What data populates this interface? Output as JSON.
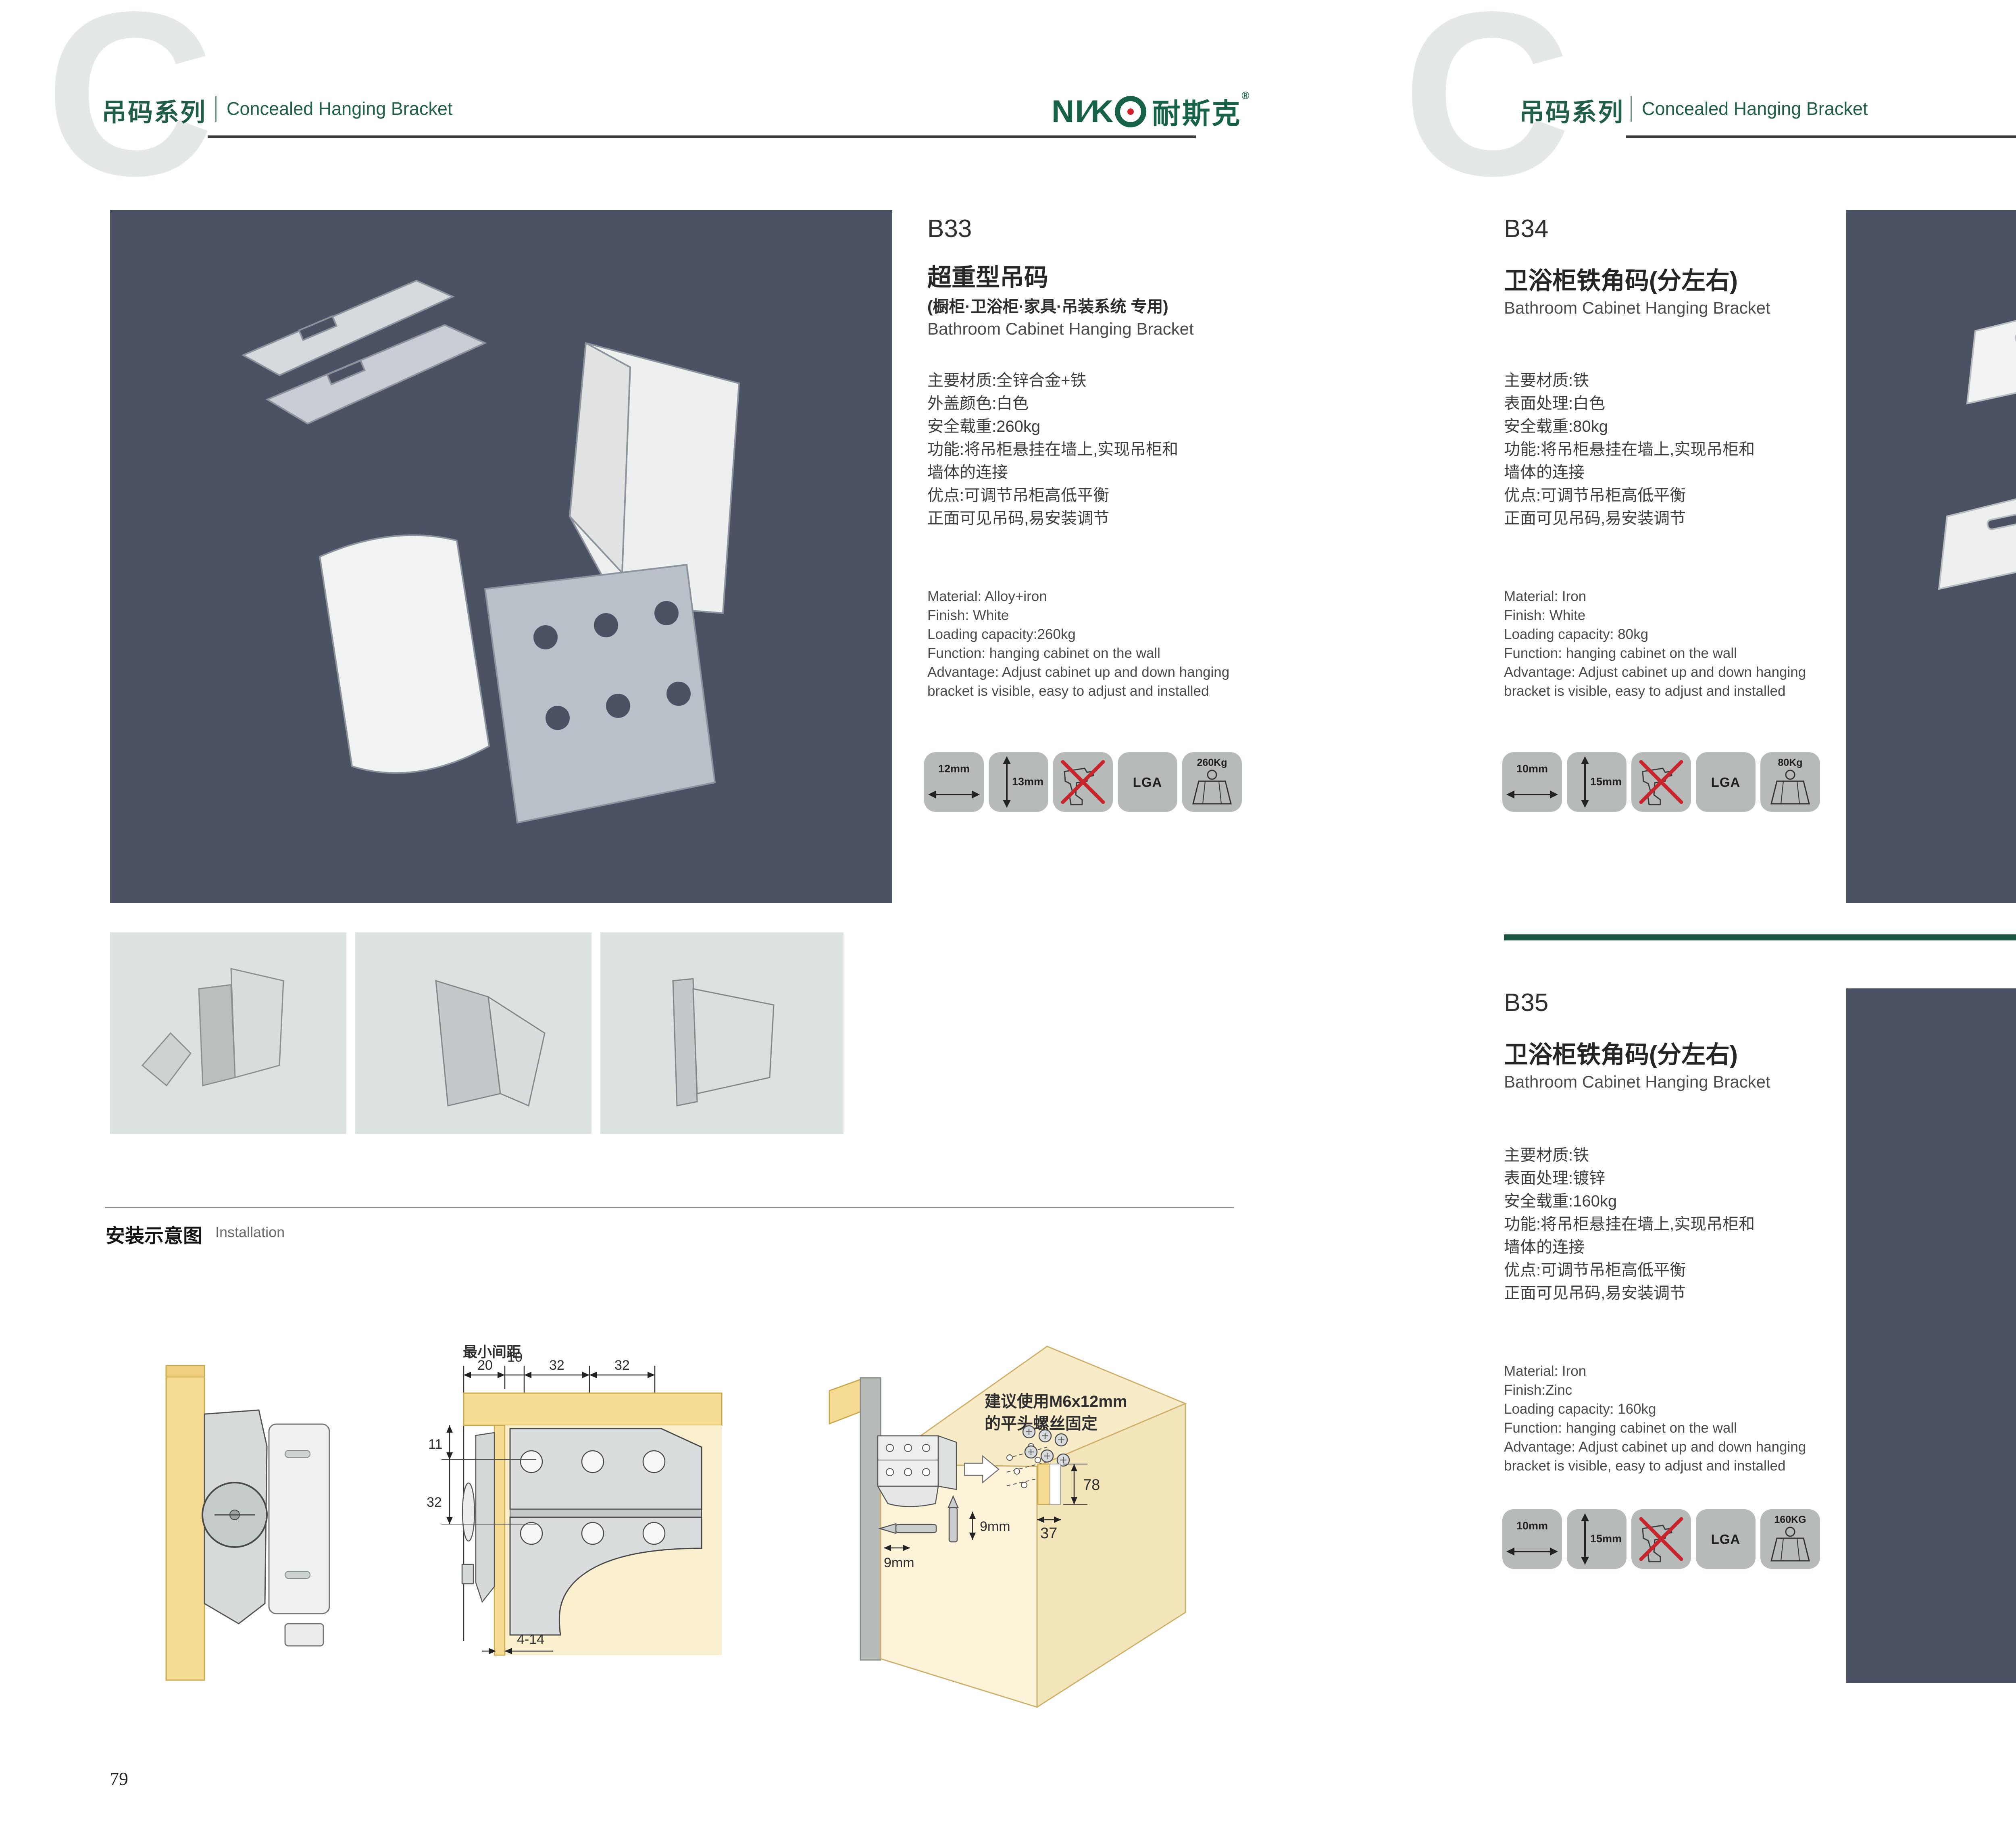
{
  "brand": {
    "watermark": "C",
    "series_zh": "吊码系列",
    "series_en": "Concealed Hanging Bracket",
    "logo_part1": "NI∕K",
    "logo_zh": "耐斯克",
    "logo_reg": "®",
    "green": "#215e49",
    "red": "#c1272d"
  },
  "page_left": {
    "number": "79"
  },
  "page_right": {
    "number": "80"
  },
  "products": {
    "b33": {
      "code": "B33",
      "title_zh": "超重型吊码",
      "subtitle_zh": "(橱柜·卫浴柜·家具·吊装系统 专用)",
      "title_en": "Bathroom Cabinet Hanging Bracket",
      "specs_zh": [
        "主要材质:全锌合金+铁",
        "外盖颜色:白色",
        "安全载重:260kg",
        "功能:将吊柜悬挂在墙上,实现吊柜和",
        "墙体的连接",
        "优点:可调节吊柜高低平衡",
        "正面可见吊码,易安装调节"
      ],
      "specs_en": [
        "Material: Alloy+iron",
        "Finish: White",
        "Loading capacity:260kg",
        "Function: hanging cabinet on the wall",
        "Advantage: Adjust cabinet up and down hanging",
        "bracket is visible, easy to adjust and installed"
      ],
      "icon_width": "12mm",
      "icon_height": "13mm",
      "icon_cert": "LGA",
      "icon_load": "260Kg"
    },
    "b34": {
      "code": "B34",
      "title_zh": "卫浴柜铁角码(分左右)",
      "title_en": "Bathroom Cabinet Hanging Bracket",
      "specs_zh": [
        "主要材质:铁",
        "表面处理:白色",
        "安全载重:80kg",
        "功能:将吊柜悬挂在墙上,实现吊柜和",
        "墙体的连接",
        "优点:可调节吊柜高低平衡",
        "正面可见吊码,易安装调节"
      ],
      "specs_en": [
        "Material: Iron",
        "Finish: White",
        "Loading capacity: 80kg",
        "Function: hanging cabinet on the wall",
        "Advantage: Adjust cabinet up and down hanging",
        "bracket is visible, easy to adjust and installed"
      ],
      "icon_width": "10mm",
      "icon_height": "15mm",
      "icon_cert": "LGA",
      "icon_load": "80Kg"
    },
    "b35": {
      "code": "B35",
      "title_zh": "卫浴柜铁角码(分左右)",
      "title_en": "Bathroom Cabinet Hanging Bracket",
      "specs_zh": [
        "主要材质:铁",
        "表面处理:镀锌",
        "安全载重:160kg",
        "功能:将吊柜悬挂在墙上,实现吊柜和",
        "墙体的连接",
        "优点:可调节吊柜高低平衡",
        "正面可见吊码,易安装调节"
      ],
      "specs_en": [
        "Material: Iron",
        "Finish:Zinc",
        "Loading capacity: 160kg",
        "Function: hanging cabinet on the wall",
        "Advantage: Adjust cabinet up and down hanging",
        "bracket is visible, easy to adjust and installed"
      ],
      "icon_width": "10mm",
      "icon_height": "15mm",
      "icon_cert": "LGA",
      "icon_load": "160KG"
    }
  },
  "installation": {
    "heading_zh": "安装示意图",
    "heading_en": "Installation",
    "min_gap": "最小间距",
    "d20": "20",
    "d10": "10",
    "d32a": "32",
    "d32b": "32",
    "d11": "11",
    "d32c": "32",
    "d4_14": "4-14",
    "note1": "建议使用M6x12mm",
    "note2": "的平头螺丝固定",
    "d78": "78",
    "d37": "37",
    "d9a": "9mm",
    "d9b": "9mm"
  }
}
